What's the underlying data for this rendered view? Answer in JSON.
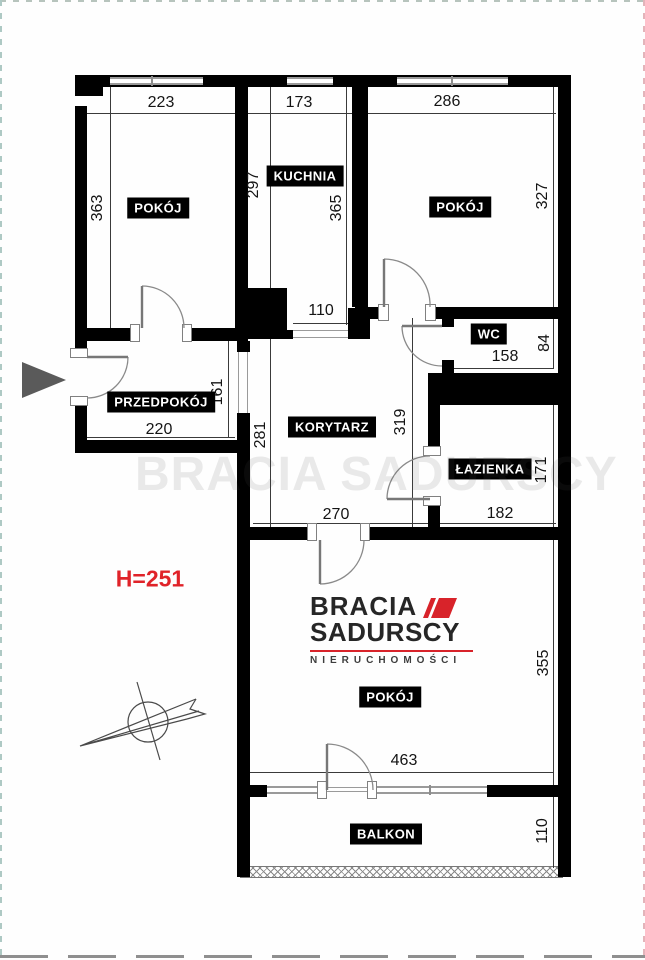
{
  "annotation": {
    "ceiling_height": "H=251"
  },
  "brand": {
    "name_line1": "BRACIA",
    "name_line2": "SADURSCY",
    "tagline": "NIERUCHOMOŚCI",
    "watermark": "BRACIA SADURSCY"
  },
  "rooms": [
    {
      "key": "pokoj-top-left",
      "label": "POKÓJ",
      "dims": {
        "width": "223",
        "height": "363"
      }
    },
    {
      "key": "kuchnia",
      "label": "KUCHNIA",
      "dims": {
        "width": "173",
        "depth_left": "297",
        "depth_right": "365",
        "doorway": "110"
      }
    },
    {
      "key": "pokoj-top-right",
      "label": "POKÓJ",
      "dims": {
        "width": "286",
        "height": "327"
      }
    },
    {
      "key": "przedpokoj",
      "label": "PRZEDPOKÓJ",
      "dims": {
        "width": "220",
        "height": "161"
      }
    },
    {
      "key": "korytarz",
      "label": "KORYTARZ",
      "dims": {
        "width": "270",
        "depth_left": "281",
        "depth_right": "319"
      }
    },
    {
      "key": "wc",
      "label": "WC",
      "dims": {
        "width": "158",
        "height": "84"
      }
    },
    {
      "key": "lazienka",
      "label": "ŁAZIENKA",
      "dims": {
        "width": "182",
        "height": "171"
      }
    },
    {
      "key": "pokoj-bottom",
      "label": "POKÓJ",
      "dims": {
        "width": "463",
        "height": "355"
      }
    },
    {
      "key": "balkon",
      "label": "BALKON",
      "dims": {
        "height": "110"
      }
    }
  ],
  "colors": {
    "wall": "#000000",
    "dim": "#141414",
    "accent_red": "#e02329",
    "logo_red": "#d8232a",
    "logo_dark": "#262626",
    "arrow_gray": "#5a5a5a"
  }
}
